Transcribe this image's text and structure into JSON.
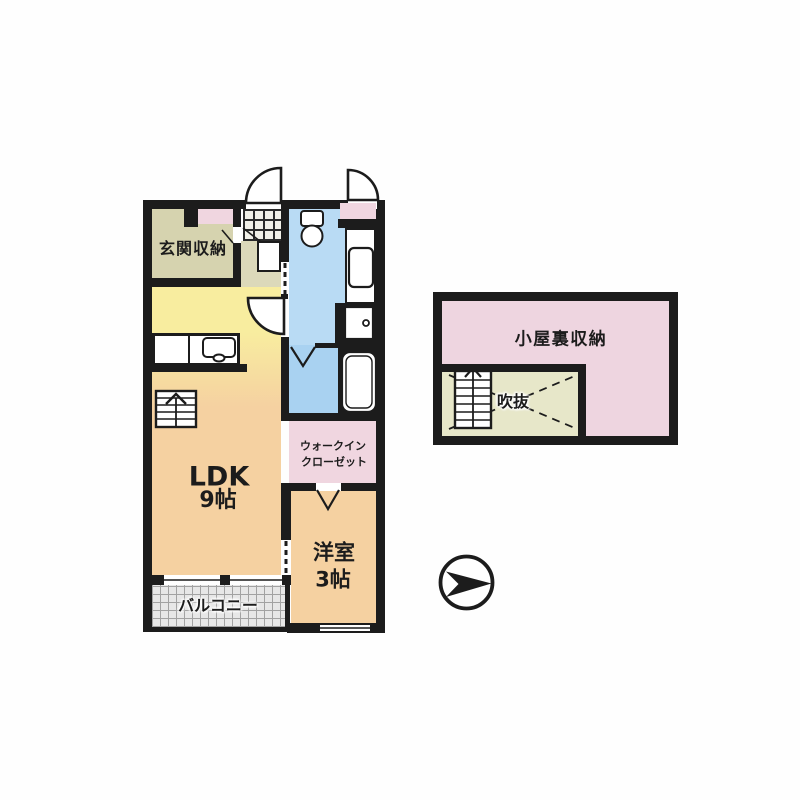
{
  "figure": {
    "kind": "apartment-floor-plan",
    "background": "#ffffff"
  },
  "colors": {
    "wall": "#1c1c1c",
    "room_orange": "#f5d1a1",
    "kitchen_yellow": "#f8ed9f",
    "storage_beige": "#d6d3af",
    "hall_beige": "#dcd9ba",
    "washroom_blue": "#b9dbf4",
    "bathroom_blue": "#a9d2f1",
    "closet_pink": "#f0d6e0",
    "void_green": "#e7e7c9",
    "balcony_gray": "#e7e7e7"
  },
  "main_plan": {
    "entrance_storage_label": "玄関収納",
    "ldk_label": "LDK",
    "ldk_size": "9帖",
    "wic_label_line1": "ウォークイン",
    "wic_label_line2": "クローゼット",
    "western_room_label": "洋室",
    "western_room_size": "3帖",
    "balcony_label": "バルコニー"
  },
  "attic_plan": {
    "attic_storage_label": "小屋裏収納",
    "void_label": "吹抜"
  },
  "icons": {
    "compass": "north-arrow-right",
    "fixtures": [
      "toilet",
      "washbasin",
      "washer-space",
      "bathtub",
      "kitchen-sink",
      "stairs",
      "attic-stairs"
    ]
  }
}
